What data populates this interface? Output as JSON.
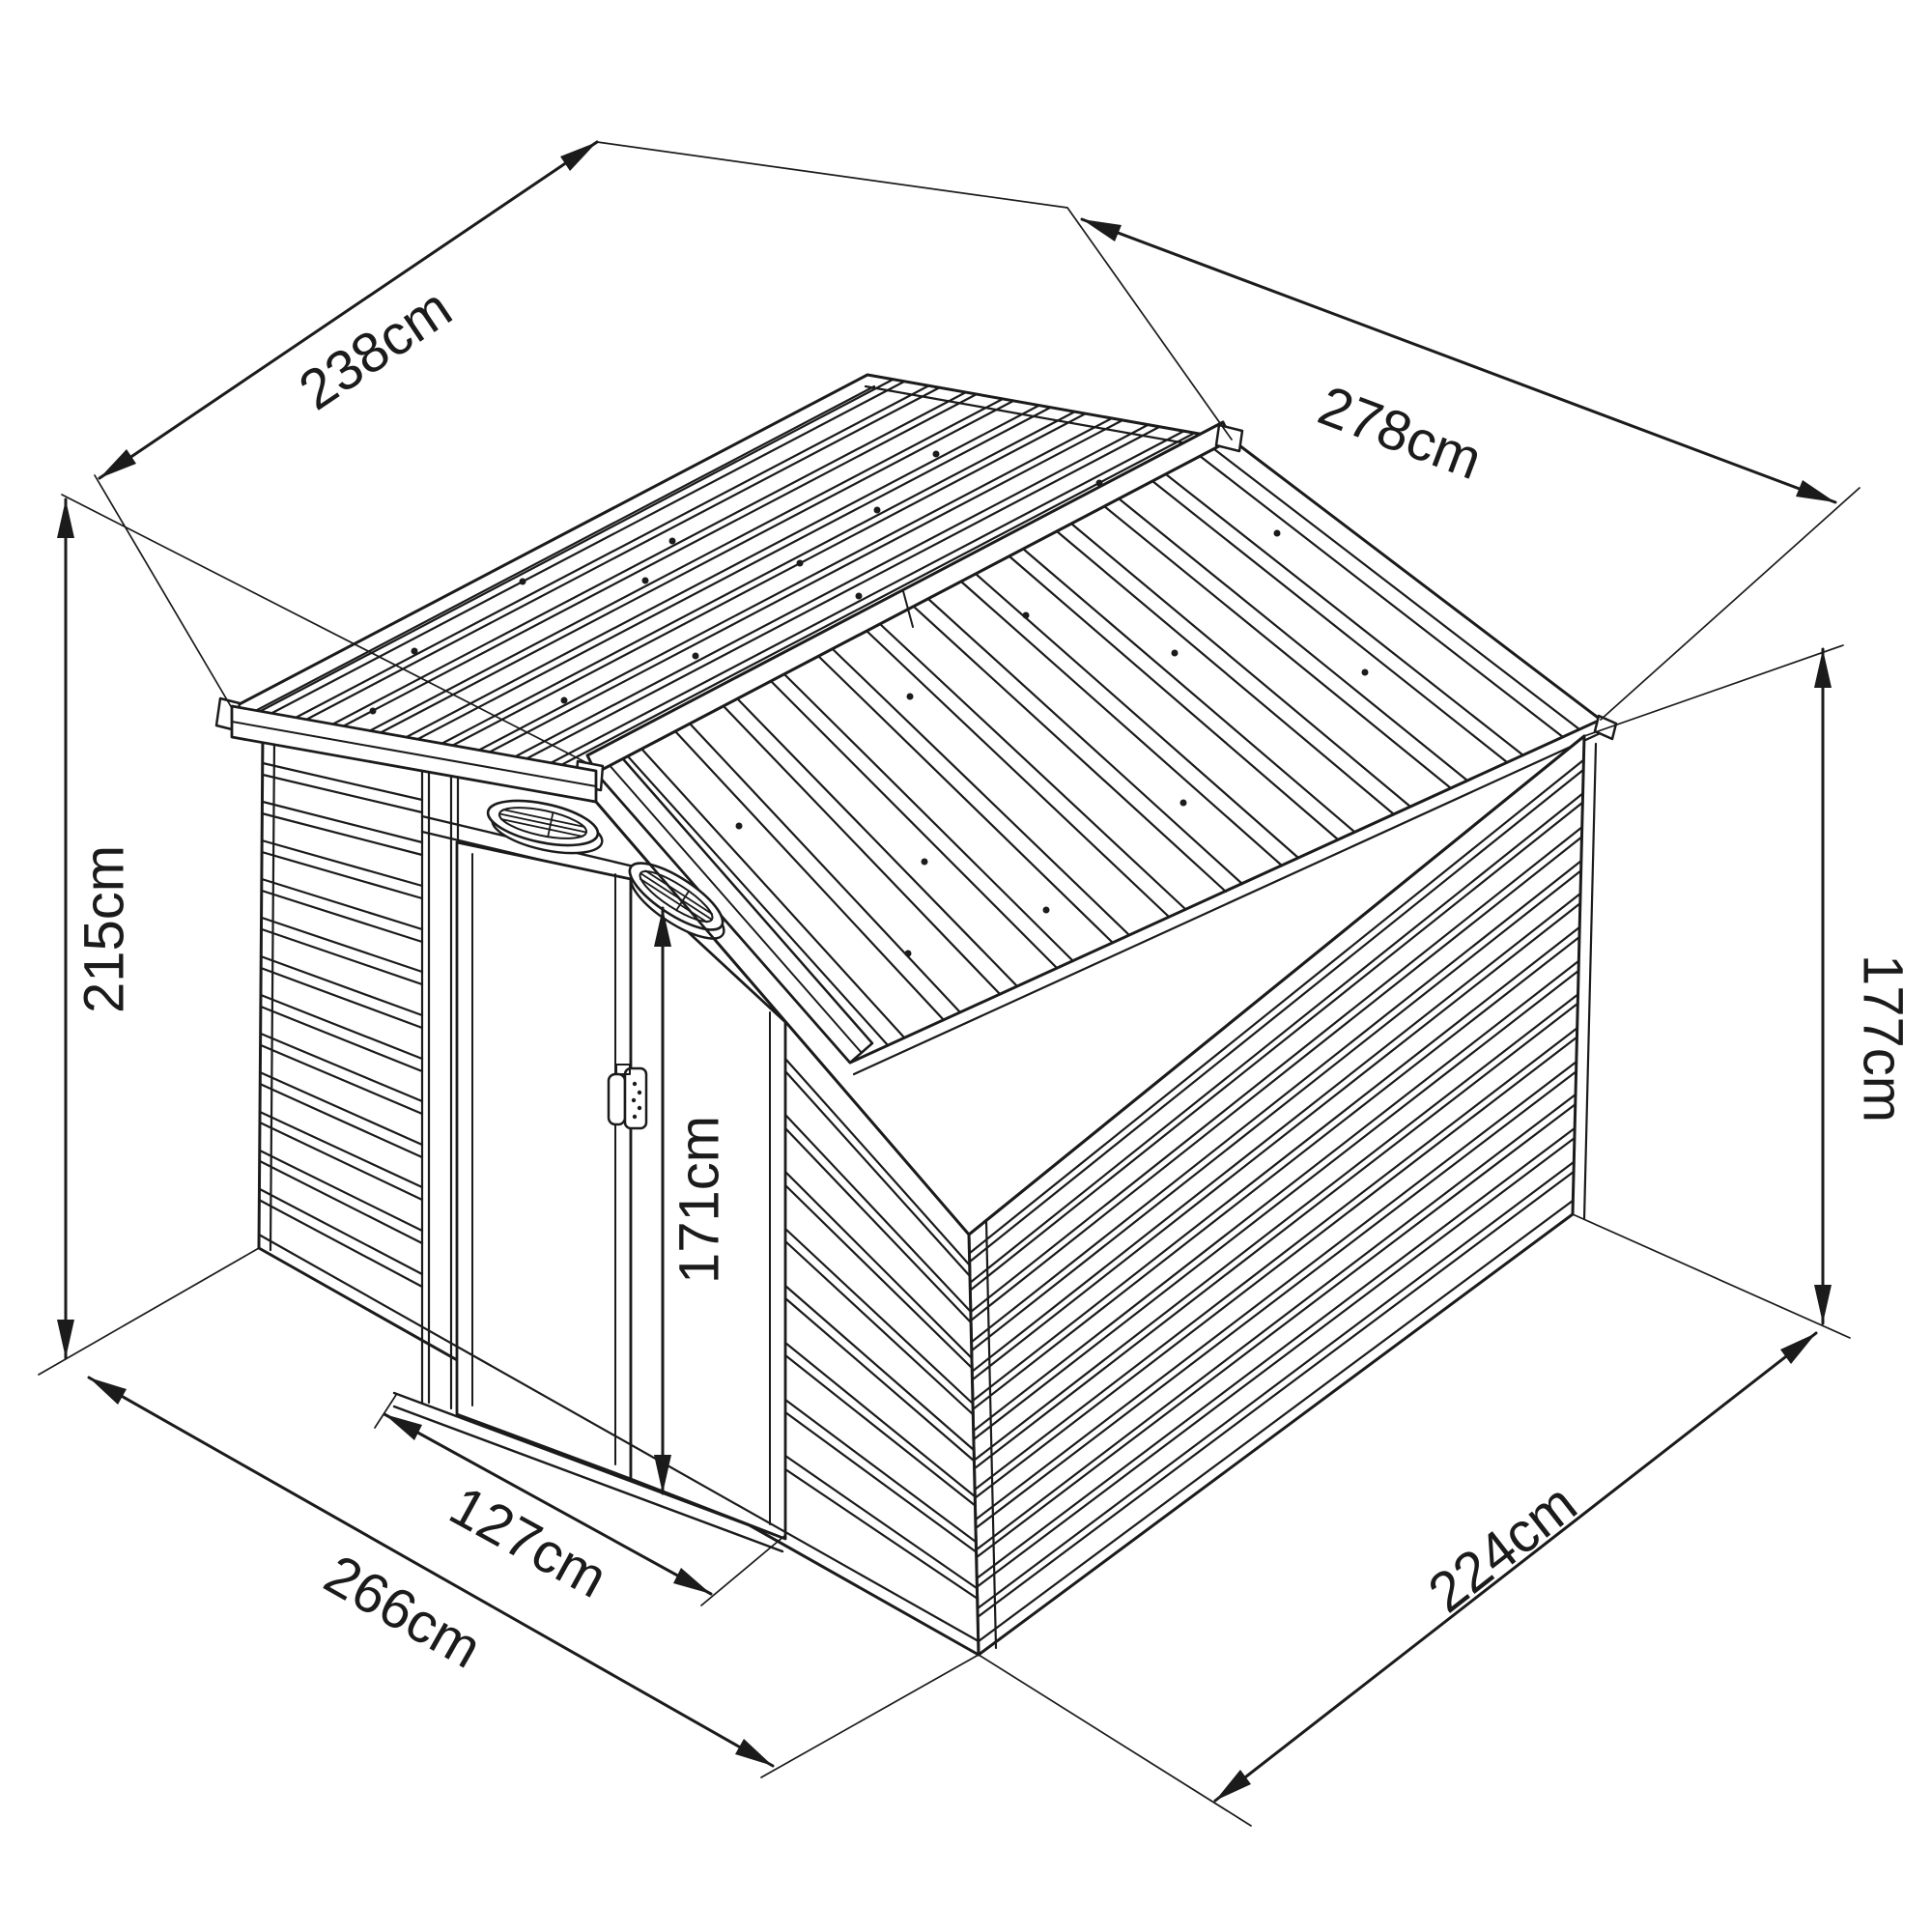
{
  "colors": {
    "line": "#1b1b1b",
    "background": "#ffffff"
  },
  "dimensions": {
    "roof_panel_width": "238cm",
    "roof_length": "278cm",
    "total_height": "215cm",
    "wall_height": "177cm",
    "door_height": "171cm",
    "door_width": "127cm",
    "base_front_width": "266cm",
    "base_side_depth": "224cm"
  }
}
